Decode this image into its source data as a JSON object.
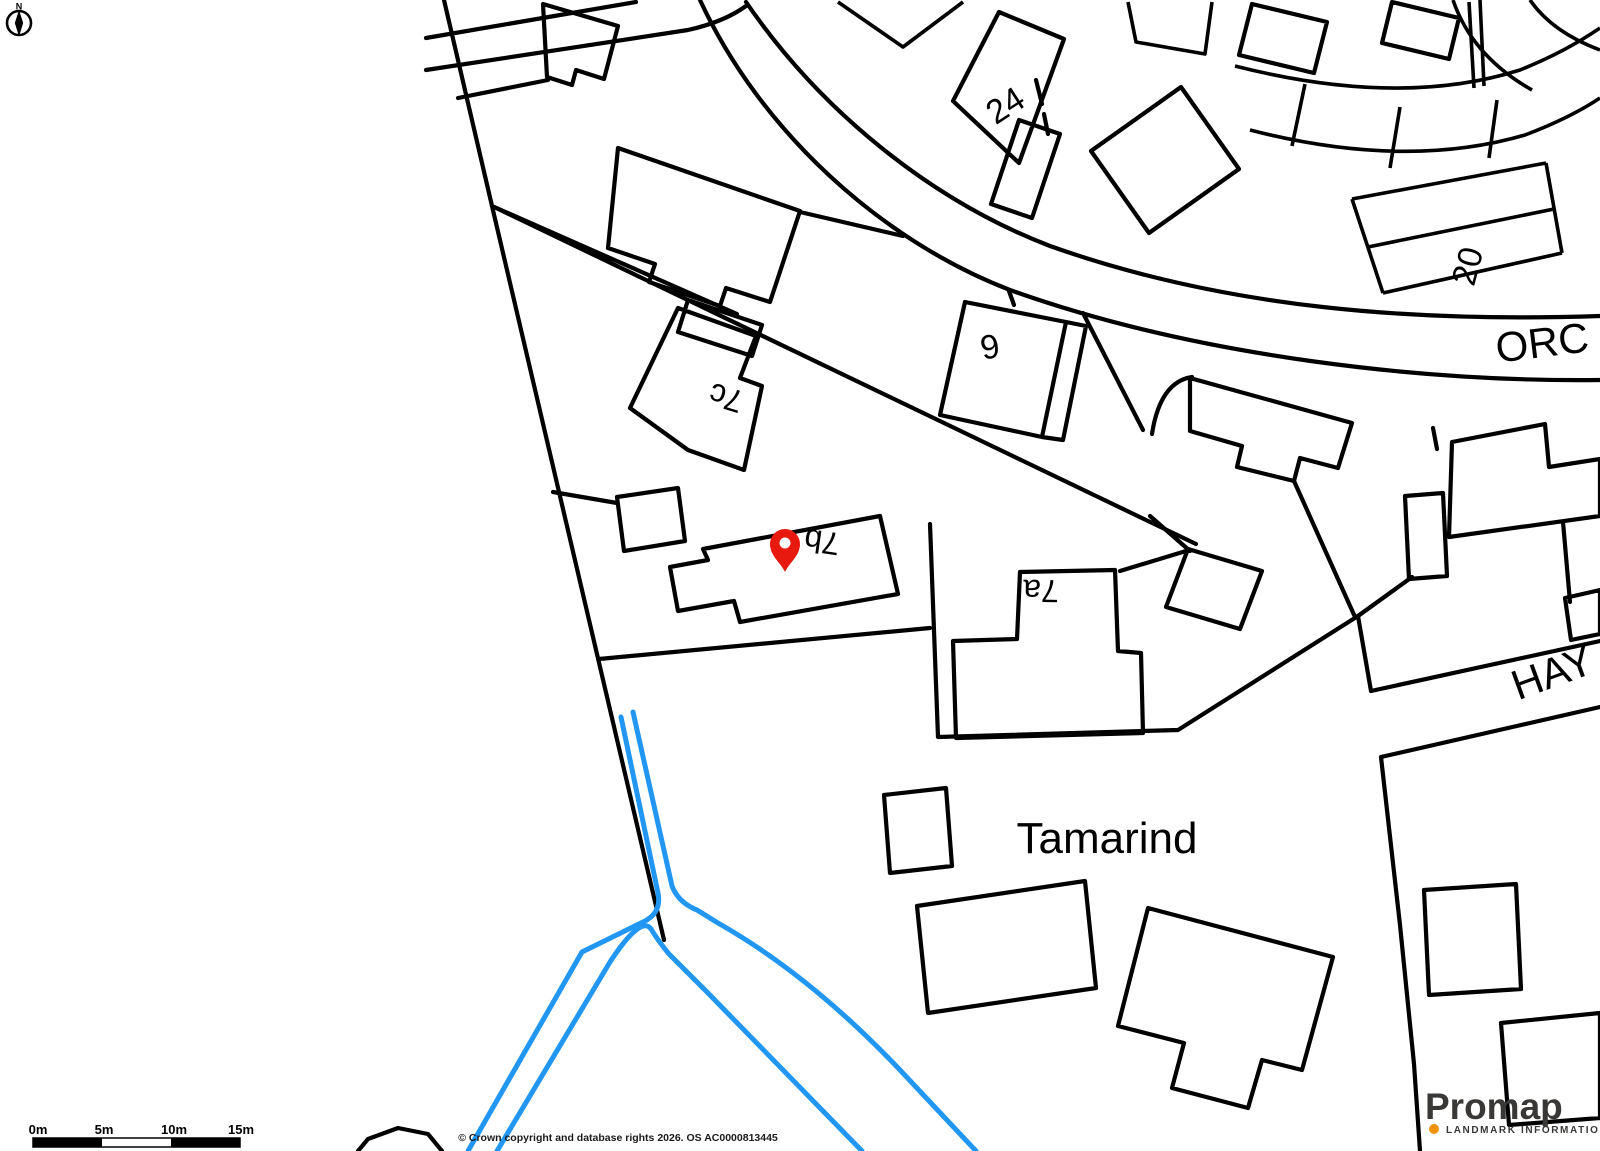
{
  "map": {
    "colors": {
      "background": "#ffffff",
      "linework": "#000000",
      "highlight_path": "#2196f3",
      "pin": "#e8190f"
    },
    "compass_label": "N",
    "plot_labels": {
      "n24": "24",
      "n20": "20",
      "n6": "6",
      "n7c": "7c",
      "n7b": "7b",
      "n7a": "7a"
    },
    "property_label": "Tamarind",
    "road_labels": {
      "orchard_partial": "ORC",
      "hay_partial": "HAY"
    }
  },
  "scale_bar": {
    "ticks": [
      "0m",
      "5m",
      "10m",
      "15m"
    ]
  },
  "attribution": "© Crown copyright and database rights 2026. OS AC0000813445",
  "logo": {
    "brand": "Promap",
    "subtitle": "LANDMARK INFORMATION",
    "brand_color": "#3a3836",
    "dot_color": "#f39200"
  }
}
